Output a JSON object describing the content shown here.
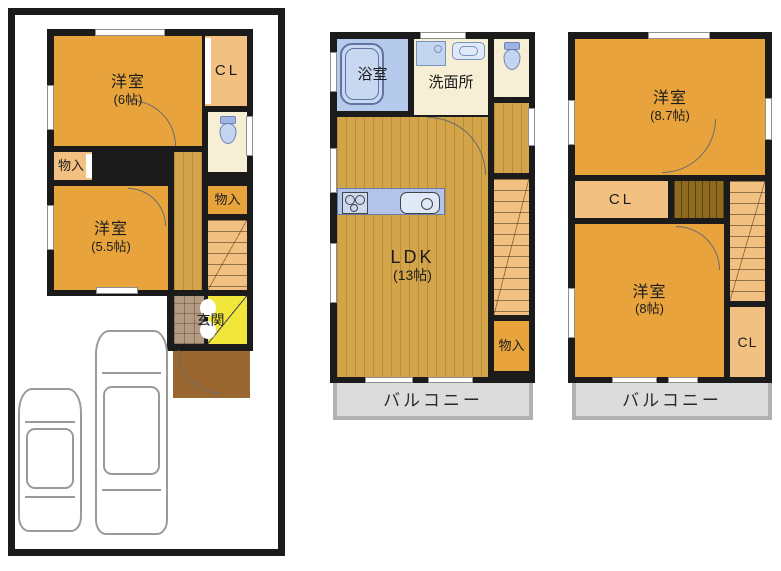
{
  "palette": {
    "wall": "#1b1b1b",
    "room_orange": "#e8a33c",
    "light_orange": "#f2c181",
    "wood": "#d3a449",
    "dark_wood": "#8e6a1e",
    "bath_blue": "#b6cbec",
    "fixture_blue": "#b3c4e8",
    "cream": "#f6efd5",
    "tile_brown": "#b29a83",
    "porch_brown": "#99672f",
    "entrance_yellow": "#f1e73b",
    "balcony_gray": "#dcdcdc"
  },
  "floor1": {
    "room_west6": {
      "name": "洋室",
      "size": "(6帖)"
    },
    "closet": {
      "label": "CL"
    },
    "storage_left": {
      "label": "物入"
    },
    "room_west55": {
      "name": "洋室",
      "size": "(5.5帖)"
    },
    "storage_right": {
      "label": "物入"
    },
    "entrance": {
      "label": "玄関"
    }
  },
  "floor2": {
    "bathroom": {
      "label": "浴室"
    },
    "washroom": {
      "label": "洗面所"
    },
    "ldk": {
      "name": "LDK",
      "size": "(13帖)"
    },
    "storage": {
      "label": "物入"
    },
    "balcony": {
      "label": "バルコニー"
    }
  },
  "floor3": {
    "room_west87": {
      "name": "洋室",
      "size": "(8.7帖)"
    },
    "closet_mid": {
      "label": "CL"
    },
    "room_west8": {
      "name": "洋室",
      "size": "(8帖)"
    },
    "closet_low": {
      "label": "CL"
    },
    "balcony": {
      "label": "バルコニー"
    }
  }
}
